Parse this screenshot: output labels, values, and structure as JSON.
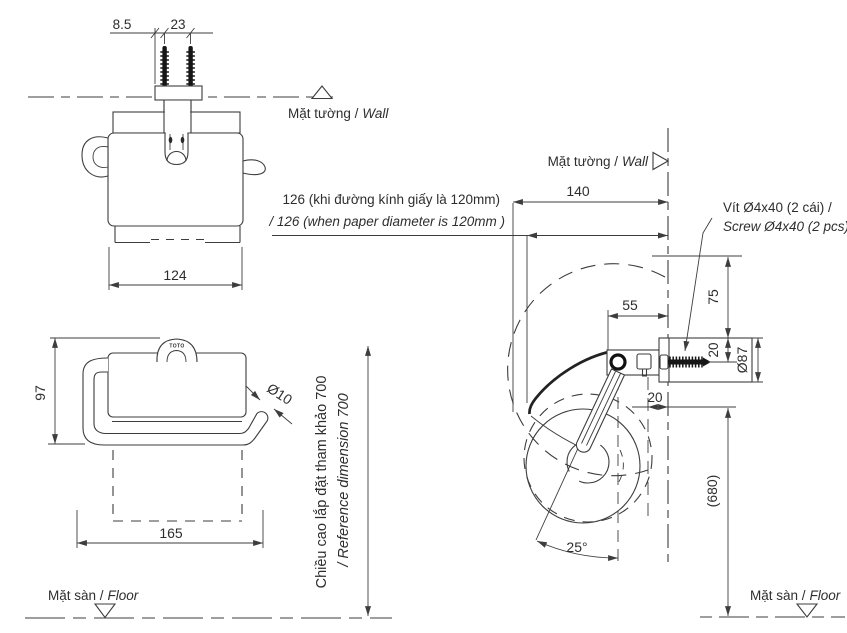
{
  "colors": {
    "line": "#3d3d3d",
    "text": "#2e2e2e",
    "black": "#161616",
    "background": "#ffffff"
  },
  "top_view": {
    "dim_left_offset": "8.5",
    "dim_screw_spacing": "23",
    "dim_width": "124",
    "wall_vi": "Mặt tường /",
    "wall_en": "Wall"
  },
  "front_view": {
    "brand": "TOTO",
    "dim_height": "97",
    "dim_width": "165",
    "dim_bar_dia": "Ø10"
  },
  "paper_note": {
    "vi": "126 (khi đường kính giấy là 120mm)",
    "en": "/ 126 (when  paper diameter is 120mm )"
  },
  "height_note": {
    "vi": "Chiều cao lắp đặt tham khảo 700",
    "en": "/ Reference dimension 700"
  },
  "side_view": {
    "wall_vi": "Mặt tường /",
    "wall_en": "Wall",
    "screw_vi": "Vít Ø4x40 (2 cái) /",
    "screw_en": "Screw Ø4x40 (2 pcs)",
    "dim_depth": "140",
    "dim_bracket": "55",
    "dim_top_offset": "75",
    "dim_screw_offset": "20",
    "dim_flange_dia": "Ø87",
    "dim_back_gap": "20",
    "dim_floor_height": "(680)",
    "dim_angle": "25°"
  },
  "floor_left": {
    "vi": "Mặt sàn /",
    "en": "Floor"
  },
  "floor_right": {
    "vi": "Mặt sàn /",
    "en": "Floor"
  }
}
